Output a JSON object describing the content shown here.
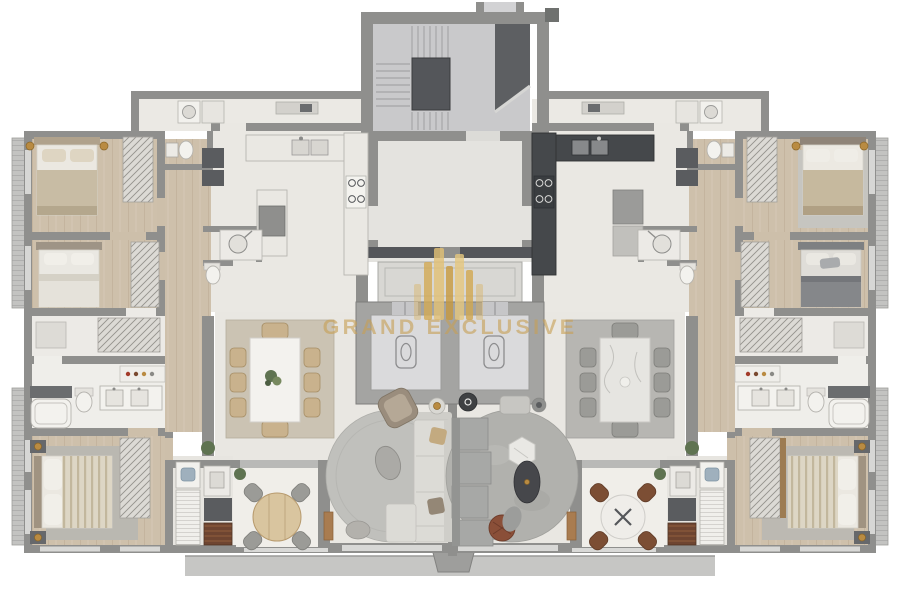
{
  "watermark": {
    "title": "GRAND EXCLUSIVE",
    "color": "#c7a055",
    "logo_icon": "skyline-logo-icon"
  },
  "palette": {
    "background": "#ffffff",
    "walls": "#8f8f8d",
    "walls_dark": "#54565a",
    "floor_tile": "#eae8e3",
    "floor_wood": "#cec0ab",
    "floor_lobby": "#e4e3df",
    "stair_floor": "#c9c9cb",
    "stair_landing": "#54565a",
    "elevator_cabin": "#dadadc",
    "kitchen_dark": "#45484b",
    "counter_light": "#eae8e3",
    "rug_beige": "#cbc3b3",
    "rug_gray": "#b7b6b2",
    "round_rug_left": "#c0c0bc",
    "round_rug_right": "#b1b1ad",
    "sofa_light": "#dcdbd6",
    "sofa_gray": "#a7a8a6",
    "bed_beige": "#c8bca4",
    "bed_gray": "#85878a",
    "wood_furniture": "#c8ad82",
    "chair_tan": "#c9b28d",
    "chair_brown": "#7c4e34",
    "grill_brown": "#6e4531",
    "slab": "#c6c6c4",
    "gold_accent": "#b98b42",
    "plant_green": "#5f7351",
    "marble_white": "#e8e7e3",
    "watermark_gold": "#c7a055"
  },
  "icons": {
    "elevator_logo": "elevator-brand-icon",
    "watermark_logo": "skyline-logo-icon",
    "shower": "shower-head-icon",
    "burners": "cooktop-burners-icon"
  }
}
